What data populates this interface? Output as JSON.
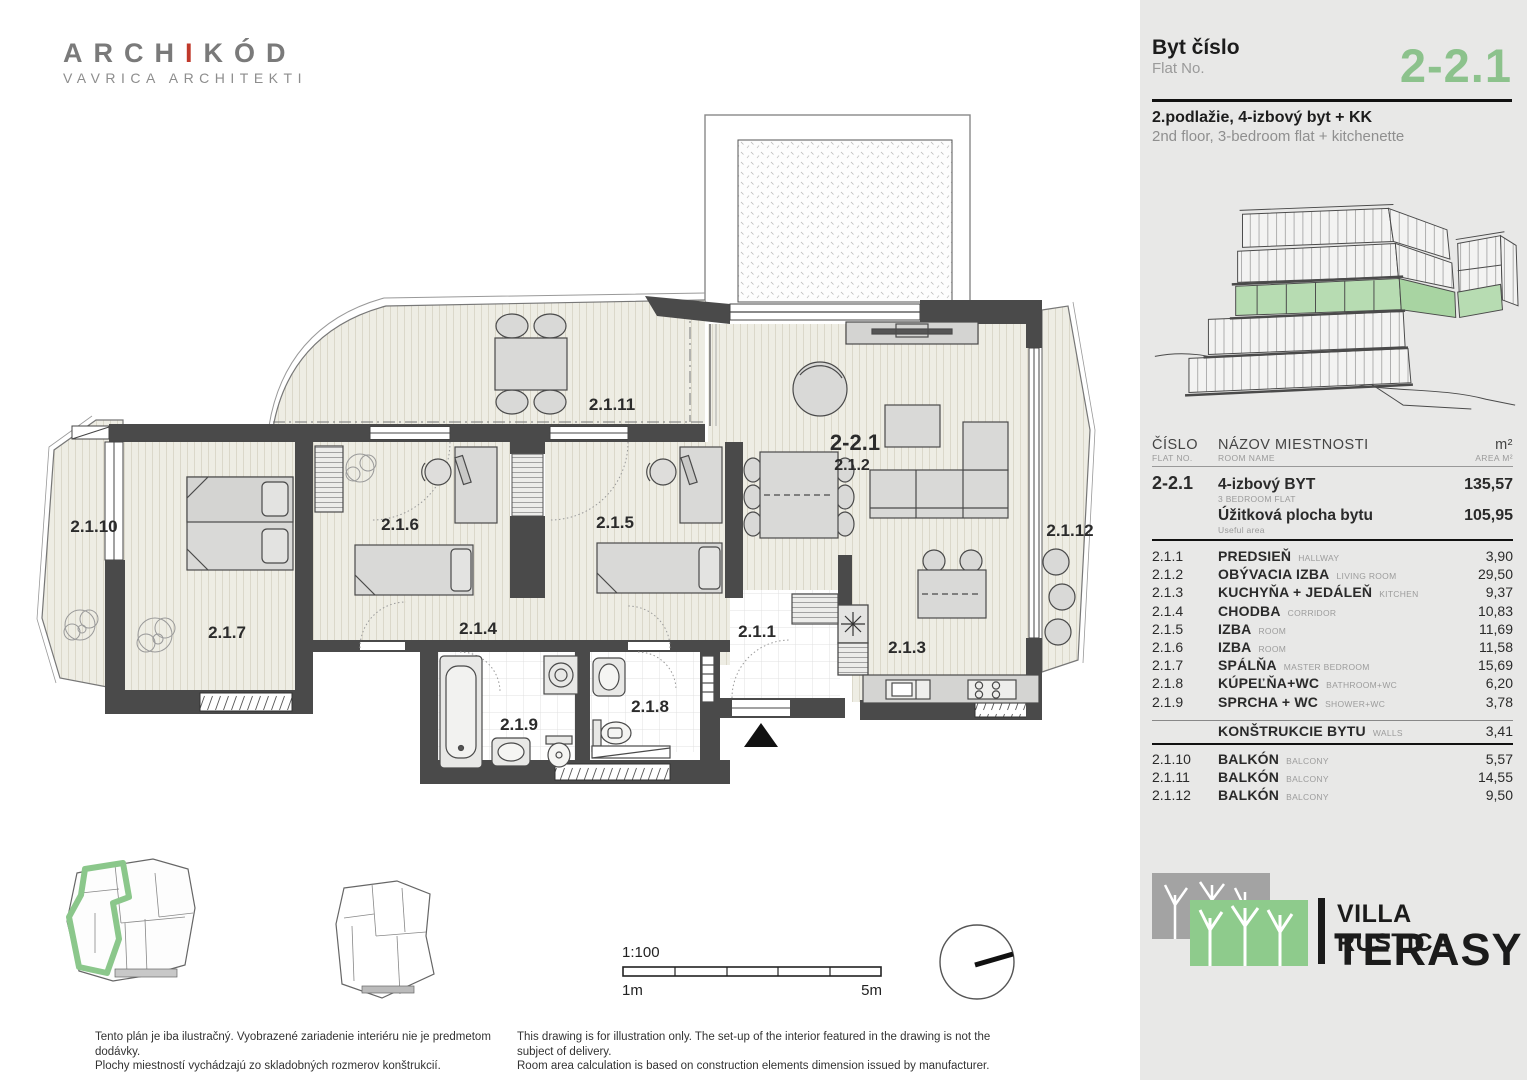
{
  "branding": {
    "logo_part1": "ARCH",
    "logo_accent": "I",
    "logo_part2": "KÓD",
    "logo_sub": "VAVRICA ARCHITEKTI"
  },
  "sidebar": {
    "flat_label_sk": "Byt číslo",
    "flat_label_en": "Flat No.",
    "flat_no": "2-2.1",
    "desc_sk": "2.podlažie, 4-izbový byt + KK",
    "desc_en": "2nd floor, 3-bedroom flat + kitchenette",
    "table": {
      "header": {
        "no_sk": "ČÍSLO",
        "no_en": "FLAT NO.",
        "name_sk": "NÁZOV  MIESTNOSTI",
        "name_en": "ROOM NAME",
        "area_sk": "m²",
        "area_en": "AREA M²"
      },
      "flat": {
        "no": "2-2.1",
        "name_sk": "4-izbový BYT",
        "name_en": "3 BEDROOM FLAT",
        "area": "135,57",
        "useful_sk": "Úžitková plocha bytu",
        "useful_en": "Useful area",
        "useful_area": "105,95"
      },
      "rooms": [
        {
          "no": "2.1.1",
          "sk": "PREDSIEŇ",
          "en": "HALLWAY",
          "area": "3,90"
        },
        {
          "no": "2.1.2",
          "sk": "OBÝVACIA IZBA",
          "en": "LIVING ROOM",
          "area": "29,50"
        },
        {
          "no": "2.1.3",
          "sk": "KUCHYŇA + JEDÁLEŇ",
          "en": "KITCHEN",
          "area": "9,37"
        },
        {
          "no": "2.1.4",
          "sk": "CHODBA",
          "en": "CORRIDOR",
          "area": "10,83"
        },
        {
          "no": "2.1.5",
          "sk": "IZBA",
          "en": "ROOM",
          "area": "11,69"
        },
        {
          "no": "2.1.6",
          "sk": "IZBA",
          "en": "ROOM",
          "area": "11,58"
        },
        {
          "no": "2.1.7",
          "sk": "SPÁLŇA",
          "en": "MASTER BEDROOM",
          "area": "15,69"
        },
        {
          "no": "2.1.8",
          "sk": "KÚPEĽŇA+WC",
          "en": "BATHROOM+WC",
          "area": "6,20"
        },
        {
          "no": "2.1.9",
          "sk": "SPRCHA + WC",
          "en": "SHOWER+WC",
          "area": "3,78"
        }
      ],
      "construction": {
        "sk": "KONŠTRUKCIE BYTU",
        "en": "WALLS",
        "area": "3,41"
      },
      "balconies": [
        {
          "no": "2.1.10",
          "sk": "BALKÓN",
          "en": "BALCONY",
          "area": "5,57"
        },
        {
          "no": "2.1.11",
          "sk": "BALKÓN",
          "en": "BALCONY",
          "area": "14,55"
        },
        {
          "no": "2.1.12",
          "sk": "BALKÓN",
          "en": "BALCONY",
          "area": "9,50"
        }
      ]
    },
    "project": {
      "line1": "VILLA RUSTICA",
      "line2": "TERASY"
    }
  },
  "plan": {
    "flat_label": "2-2.1",
    "labels": {
      "balcony10": "2.1.10",
      "bedroom7": "2.1.7",
      "room6": "2.1.6",
      "terrace11": "2.1.11",
      "room5": "2.1.5",
      "corridor4": "2.1.4",
      "bath9": "2.1.9",
      "wc8": "2.1.8",
      "hall1": "2.1.1",
      "living2": "2.1.2",
      "kitchen3": "2.1.3",
      "balcony12": "2.1.12"
    }
  },
  "scale": {
    "ratio": "1:100",
    "from": "1m",
    "to": "5m"
  },
  "footer": {
    "sk1": "Tento plán je iba ilustračný. Vyobrazené zariadenie interiéru nie je predmetom dodávky.",
    "sk2": "Plochy miestností vychádzajú zo skladobných rozmerov konštrukcií.",
    "en1": "This drawing is for illustration only. The set-up of the interior featured in the drawing is not the subject of delivery.",
    "en2": "Room area calculation is based on construction elements dimension issued by manufacturer."
  },
  "colors": {
    "accent_green": "#8cc28c",
    "logo_green": "#8ecb8c",
    "logo_gray": "#a3a3a3",
    "wall": "#4a4a4a",
    "floor": "#eeede4"
  }
}
